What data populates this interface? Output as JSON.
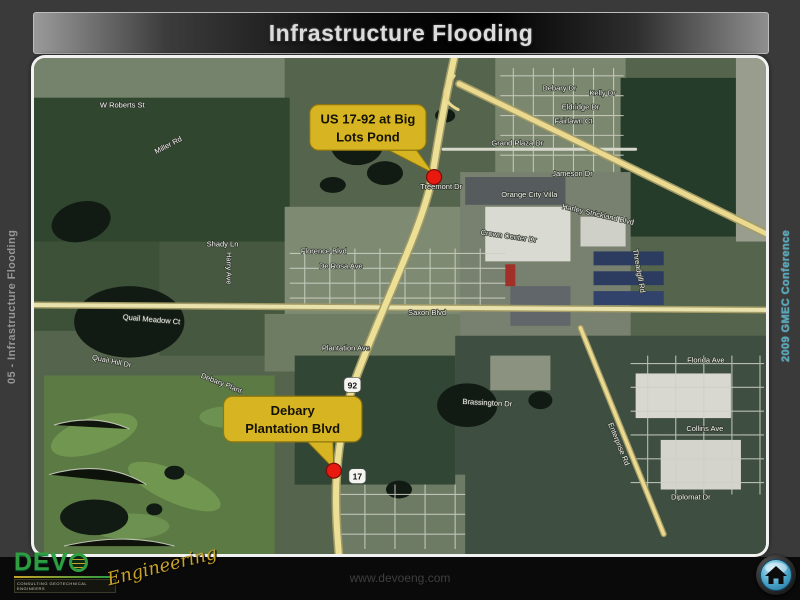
{
  "header": {
    "title": "Infrastructure Flooding"
  },
  "sidebars": {
    "left_label": "05 - Infrastructure Flooding",
    "right_label": "2009 GMEC Conference"
  },
  "map": {
    "callouts": [
      {
        "line1": "US 17-92 at Big",
        "line2": "Lots Pond"
      },
      {
        "line1": "Debary",
        "line2": "Plantation Blvd"
      }
    ],
    "route_shields": [
      {
        "number": "92"
      },
      {
        "number": "17"
      }
    ],
    "street_labels": [
      {
        "text": "W Roberts St"
      },
      {
        "text": "Miller Rd"
      },
      {
        "text": "Debary Dr"
      },
      {
        "text": "Kelly Dr"
      },
      {
        "text": "Eldridge Dr"
      },
      {
        "text": "Fairlawn Ct"
      },
      {
        "text": "Grand Plaza Dr"
      },
      {
        "text": "Jameson Dr"
      },
      {
        "text": "Treemont Dr"
      },
      {
        "text": "Orange City Villa"
      },
      {
        "text": "Harley Strickland Blvd"
      },
      {
        "text": "Crown Center Dr"
      },
      {
        "text": "Shady Ln"
      },
      {
        "text": "Florence Blvd"
      },
      {
        "text": "De Rosa Ave"
      },
      {
        "text": "Harry Ave"
      },
      {
        "text": "Saxon Blvd"
      },
      {
        "text": "Quail Meadow Ct"
      },
      {
        "text": "Quail Hill Dr"
      },
      {
        "text": "Plantation Ave"
      },
      {
        "text": "Debary Plant"
      },
      {
        "text": "Brassington Dr"
      },
      {
        "text": "Florida Ave"
      },
      {
        "text": "Collins Ave"
      },
      {
        "text": "Diplomat Dr"
      },
      {
        "text": "Enterprise Rd"
      },
      {
        "text": "Threadgill Rd"
      }
    ]
  },
  "footer": {
    "logo": {
      "brand_prefix": "DEV",
      "script": "Engineering",
      "tagline": "CONSULTING GEOTECHNICAL ENGINEERS"
    },
    "website": "www.devoeng.com"
  },
  "colors": {
    "callout_bg": "#d7b522",
    "marker_red": "#e81a10",
    "road_yellow": "#ecdf96",
    "header_title": "#dcdcdc",
    "left_label": "#969696",
    "right_label": "#55a7ba",
    "devo_green": "#2f9e41",
    "devo_gold": "#c9a227"
  }
}
